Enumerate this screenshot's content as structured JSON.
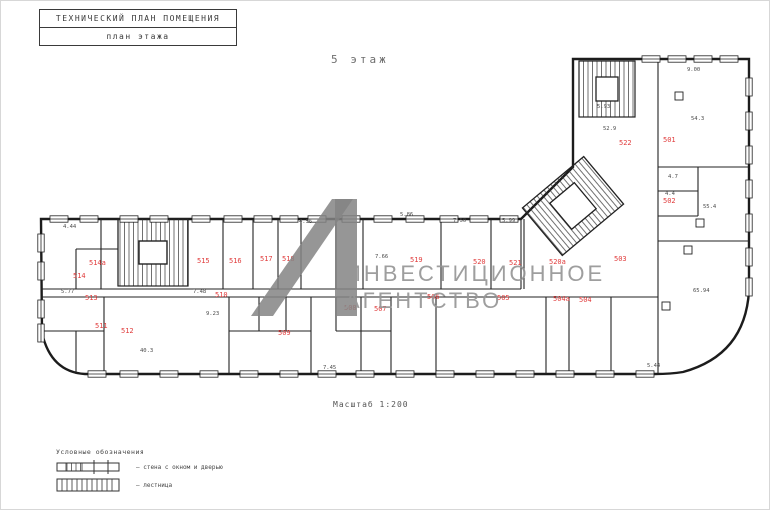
{
  "title_block": {
    "line1": "ТЕХНИЧЕСКИЙ  ПЛАН ПОМЕЩЕНИЯ",
    "line2": "план этажа"
  },
  "floor_label": "5 этаж",
  "scale_label": "Масштаб 1:200",
  "watermark": {
    "line1": "ИНВЕСТИЦИОННОЕ",
    "line2": "АГЕНТСТВО",
    "color": "#8c8c8c"
  },
  "legend": {
    "title": "Условные обозначения",
    "items": [
      {
        "label": "– стена с окном и дверью"
      },
      {
        "label": "– лестница"
      }
    ]
  },
  "plan": {
    "label_color": "#e03c3c",
    "dim_color": "#4a4a4a",
    "wall_color": "#1c1c1c",
    "room_labels": [
      {
        "t": "501",
        "x": 662,
        "y": 141
      },
      {
        "t": "502",
        "x": 662,
        "y": 202
      },
      {
        "t": "503",
        "x": 613,
        "y": 260
      },
      {
        "t": "504",
        "x": 578,
        "y": 301
      },
      {
        "t": "504а",
        "x": 552,
        "y": 300
      },
      {
        "t": "505",
        "x": 496,
        "y": 299
      },
      {
        "t": "506",
        "x": 426,
        "y": 298
      },
      {
        "t": "507",
        "x": 373,
        "y": 310
      },
      {
        "t": "508",
        "x": 343,
        "y": 309
      },
      {
        "t": "509",
        "x": 277,
        "y": 334
      },
      {
        "t": "510",
        "x": 214,
        "y": 296
      },
      {
        "t": "511",
        "x": 94,
        "y": 327
      },
      {
        "t": "512",
        "x": 120,
        "y": 332
      },
      {
        "t": "513",
        "x": 84,
        "y": 299
      },
      {
        "t": "514",
        "x": 72,
        "y": 277
      },
      {
        "t": "514а",
        "x": 88,
        "y": 264
      },
      {
        "t": "515",
        "x": 196,
        "y": 262
      },
      {
        "t": "516",
        "x": 228,
        "y": 262
      },
      {
        "t": "517",
        "x": 259,
        "y": 260
      },
      {
        "t": "518",
        "x": 281,
        "y": 260
      },
      {
        "t": "519",
        "x": 409,
        "y": 261
      },
      {
        "t": "520",
        "x": 472,
        "y": 263
      },
      {
        "t": "520а",
        "x": 548,
        "y": 263
      },
      {
        "t": "521",
        "x": 508,
        "y": 264
      },
      {
        "t": "522",
        "x": 618,
        "y": 144
      }
    ],
    "dims": [
      {
        "t": "4.44",
        "x": 62,
        "y": 227
      },
      {
        "t": "5.77",
        "x": 60,
        "y": 292
      },
      {
        "t": "7.48",
        "x": 192,
        "y": 292
      },
      {
        "t": "4.56",
        "x": 298,
        "y": 222
      },
      {
        "t": "5.86",
        "x": 399,
        "y": 215
      },
      {
        "t": "7.50",
        "x": 452,
        "y": 221
      },
      {
        "t": "5.99",
        "x": 501,
        "y": 221
      },
      {
        "t": "7.66",
        "x": 374,
        "y": 257
      },
      {
        "t": "9.23",
        "x": 205,
        "y": 314
      },
      {
        "t": "40.3",
        "x": 139,
        "y": 351
      },
      {
        "t": "9.00",
        "x": 686,
        "y": 70
      },
      {
        "t": "5.93",
        "x": 596,
        "y": 107
      },
      {
        "t": "52.9",
        "x": 602,
        "y": 129
      },
      {
        "t": "54.3",
        "x": 690,
        "y": 119
      },
      {
        "t": "4.7",
        "x": 667,
        "y": 177
      },
      {
        "t": "4.4",
        "x": 664,
        "y": 194
      },
      {
        "t": "55.4",
        "x": 702,
        "y": 207
      },
      {
        "t": "65.94",
        "x": 692,
        "y": 291
      },
      {
        "t": "7.45",
        "x": 322,
        "y": 368
      },
      {
        "t": "5.44",
        "x": 646,
        "y": 366
      }
    ]
  }
}
